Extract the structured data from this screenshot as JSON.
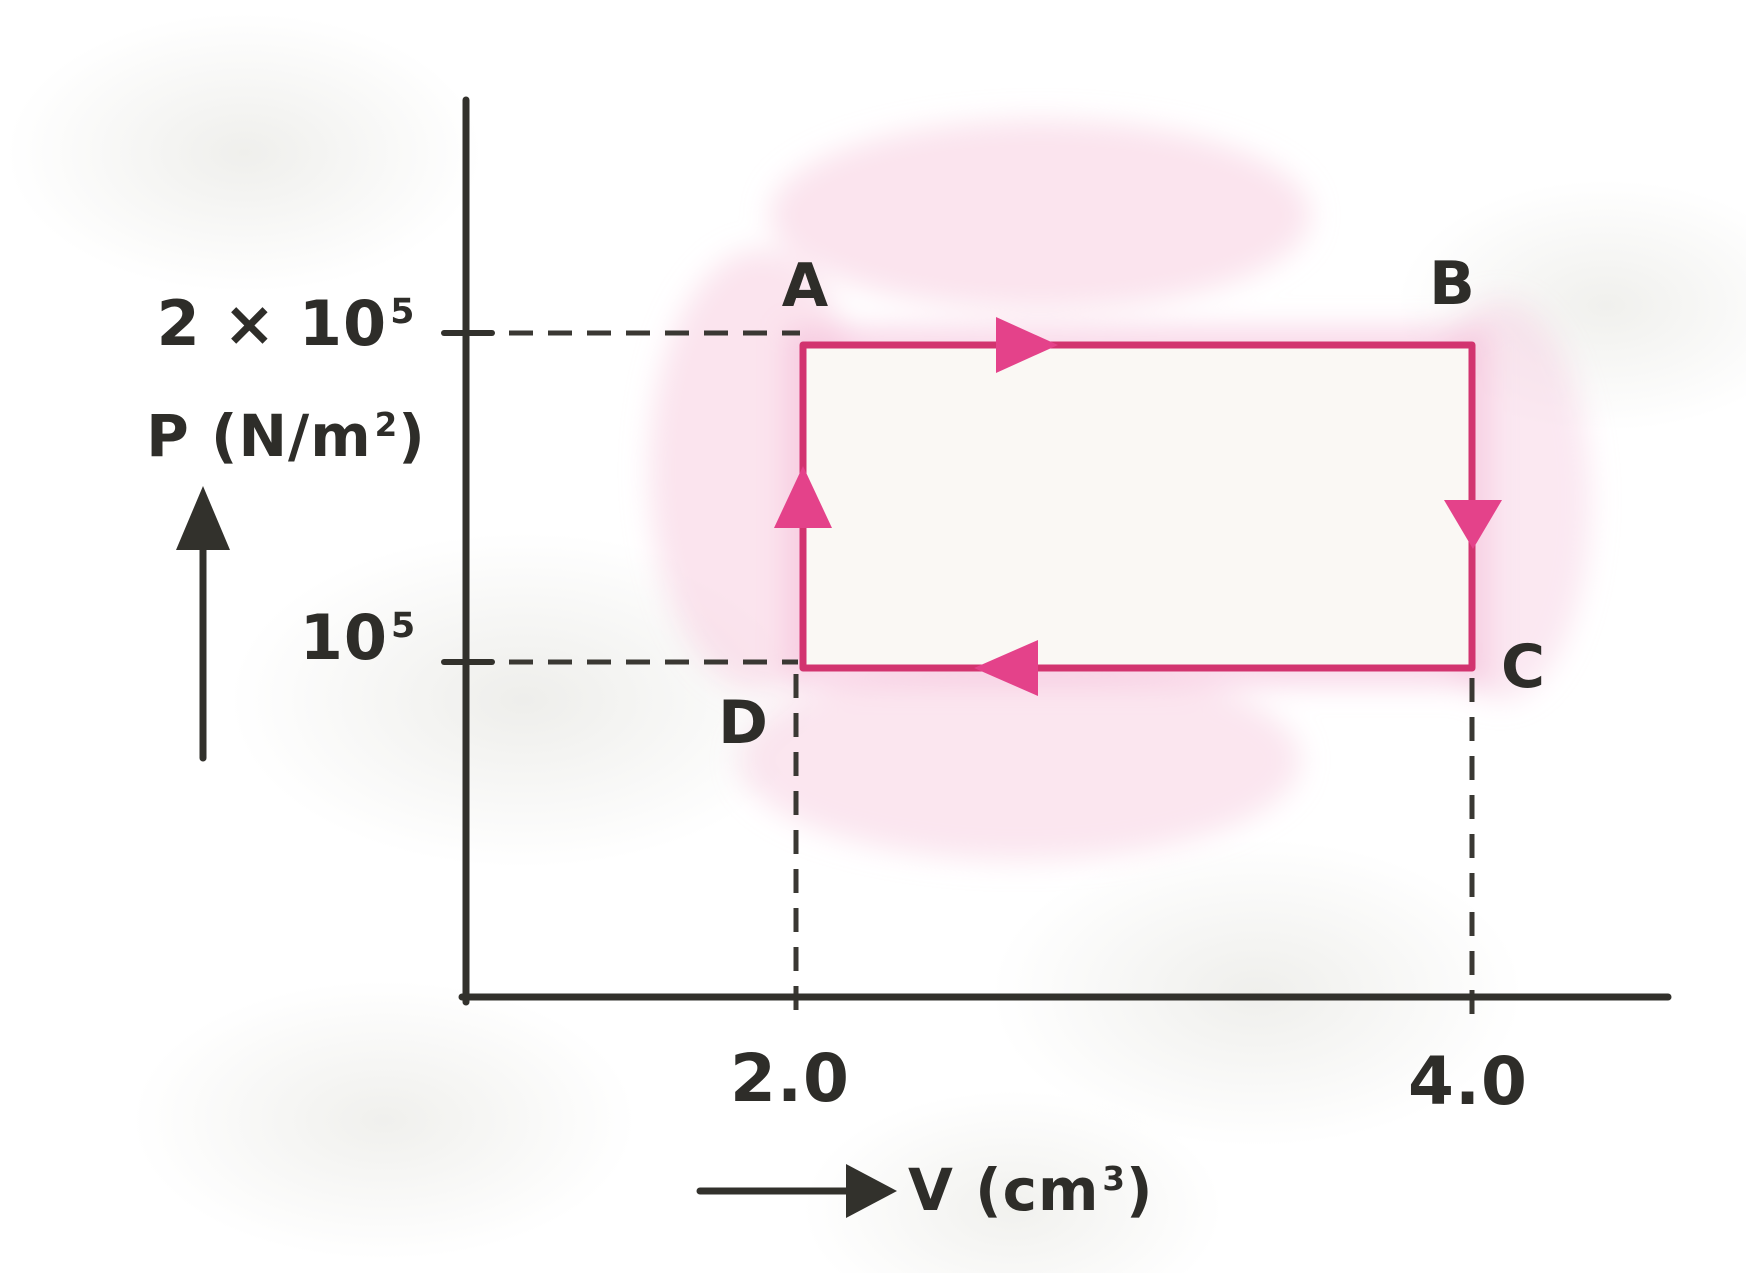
{
  "figure": {
    "description": "Hand-drawn pressure-volume diagram of a rectangular thermodynamic cycle A-B-C-D",
    "ink_color": "#32312c",
    "accent_color": "#d2346f",
    "accent_glow": "#f5bcd8",
    "cycle_fill": "#faf8f4"
  },
  "axes": {
    "y_label": {
      "pre": "P (N/m",
      "sup": "2",
      "post": ")"
    },
    "x_label": {
      "pre": "V (cm",
      "sup": "3",
      "post": ")"
    },
    "y_ticks": [
      {
        "base": "2 × 10",
        "sup": "5",
        "value": 200000
      },
      {
        "base": "10",
        "sup": "5",
        "value": 100000
      }
    ],
    "x_ticks": [
      {
        "label": "2.0",
        "value": 2.0
      },
      {
        "label": "4.0",
        "value": 4.0
      }
    ]
  },
  "points": [
    {
      "label": "A",
      "V": 2.0,
      "P": 200000
    },
    {
      "label": "B",
      "V": 4.0,
      "P": 200000
    },
    {
      "label": "C",
      "V": 4.0,
      "P": 100000
    },
    {
      "label": "D",
      "V": 2.0,
      "P": 100000
    }
  ],
  "process_arrows": [
    {
      "from": "A",
      "to": "B",
      "direction": "right"
    },
    {
      "from": "B",
      "to": "C",
      "direction": "down"
    },
    {
      "from": "C",
      "to": "D",
      "direction": "left"
    },
    {
      "from": "D",
      "to": "A",
      "direction": "up"
    }
  ],
  "chart_data": {
    "type": "line",
    "title": "",
    "xlabel": "V (cm³)",
    "ylabel": "P (N/m²)",
    "x_ticks": [
      2.0,
      4.0
    ],
    "y_ticks": [
      100000,
      200000
    ],
    "xlim": [
      0,
      5
    ],
    "ylim": [
      0,
      250000
    ],
    "grid": false,
    "series": [
      {
        "name": "thermodynamic cycle A→B→C→D→A",
        "closed": true,
        "points": [
          {
            "label": "A",
            "x": 2.0,
            "y": 200000
          },
          {
            "label": "B",
            "x": 4.0,
            "y": 200000
          },
          {
            "label": "C",
            "x": 4.0,
            "y": 100000
          },
          {
            "label": "D",
            "x": 2.0,
            "y": 100000
          }
        ]
      }
    ]
  }
}
